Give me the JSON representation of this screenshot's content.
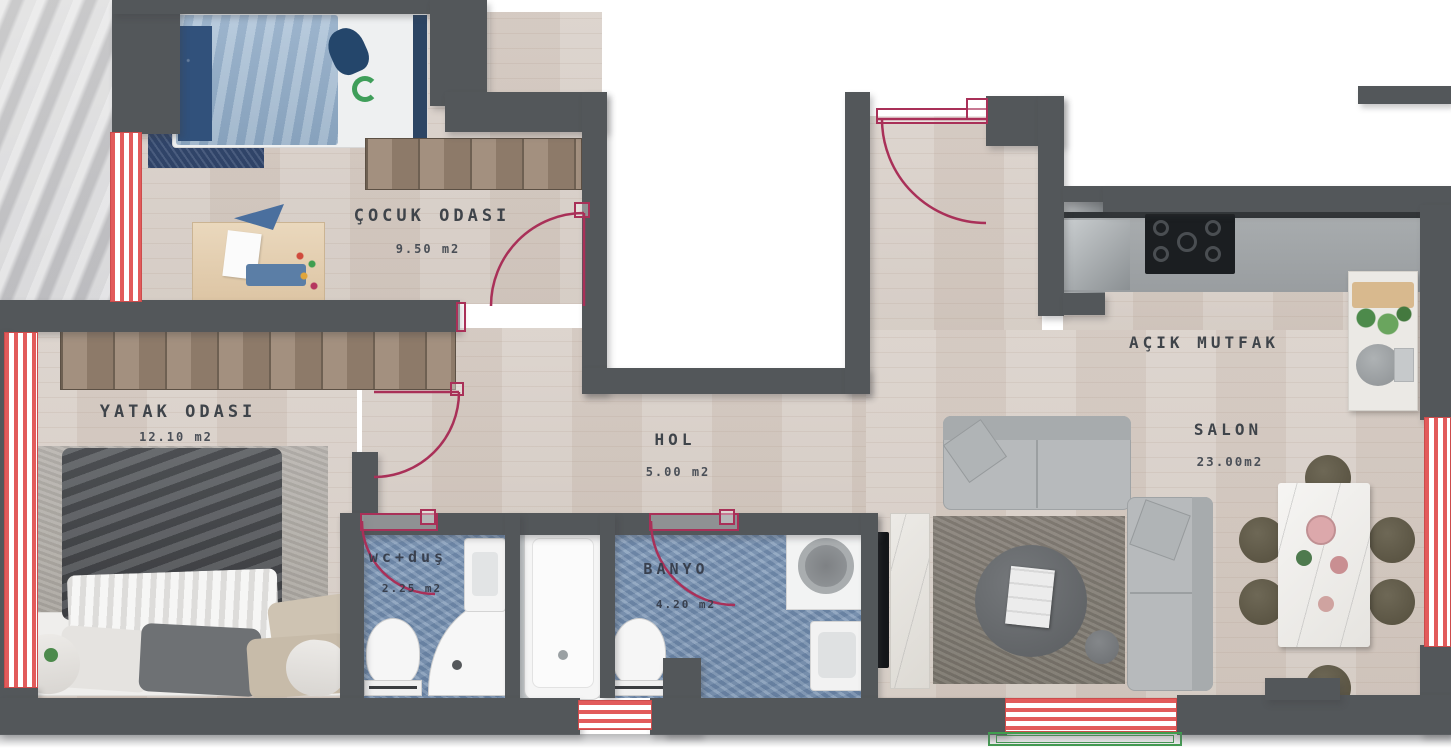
{
  "plan_title": "apartment floor plan",
  "rooms": {
    "cocuk": {
      "name": "ÇOCUK ODASI",
      "area": "9.50 m2"
    },
    "yatak": {
      "name": "YATAK ODASI",
      "area": "12.10 m2"
    },
    "hol": {
      "name": "HOL",
      "area": "5.00 m2"
    },
    "wc": {
      "name": "wc+duş",
      "area": "2.25 m2"
    },
    "banyo": {
      "name": "BANYO",
      "area": "4.20 m2"
    },
    "mutfak": {
      "name": "AÇIK MUTFAK"
    },
    "salon": {
      "name": "SALON",
      "area": "23.00m2"
    }
  },
  "colors": {
    "wall": "#53575a",
    "wood_floor": "#d6cdc6",
    "bath_tile": "#7e97b8",
    "door_swing": "#a93058",
    "window_red": "#e25b5b",
    "balcony_green": "#3f9e4f",
    "exterior_marble": "#cfcfcf"
  }
}
